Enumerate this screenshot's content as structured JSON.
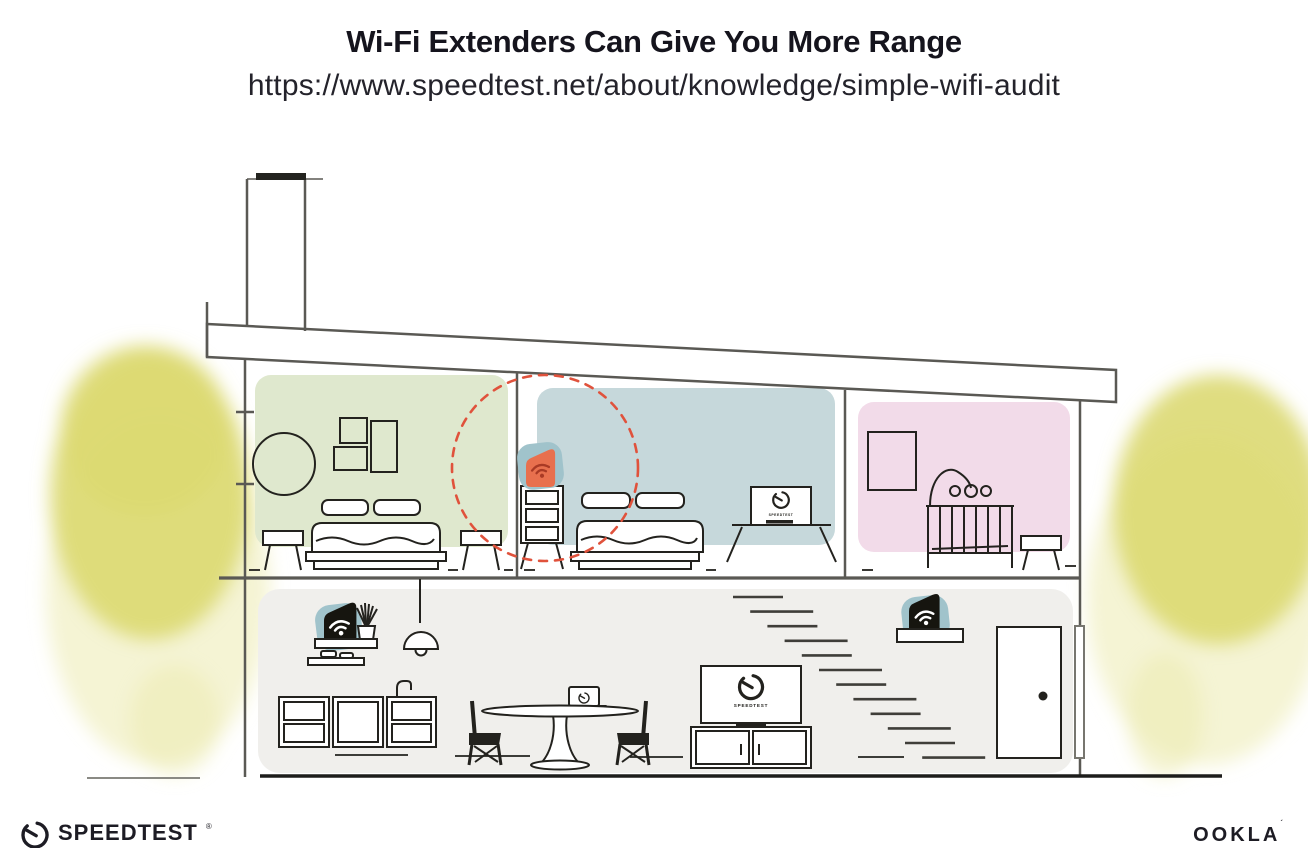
{
  "header": {
    "title": "Wi-Fi Extenders Can Give You More Range",
    "url": "https://www.speedtest.net/about/knowledge/simple-wifi-audit"
  },
  "footer": {
    "speedtest_wordmark": "SPEEDTEST",
    "speedtest_trademark": "®",
    "ookla_wordmark": "OOKLA",
    "ookla_trademark": "´"
  },
  "illustration": {
    "scene": "Cross-section of a two-story house showing a Wi-Fi router downstairs and Wi-Fi extenders, one upstairs circled with a dashed coverage ring",
    "tv_screen_label": "SPEEDTEST",
    "coverage_circle": "red dashed ring around upstairs wi-fi extender",
    "rooms": [
      {
        "name": "bedroom-green",
        "fill": "#dfe8ce",
        "furniture": [
          "round-mirror",
          "three-wall-frames",
          "double-bed",
          "two-nightstands"
        ]
      },
      {
        "name": "bedroom-blue",
        "fill": "#c6d8db",
        "furniture": [
          "dresser",
          "double-bed",
          "tv-on-stand"
        ],
        "device": "wifi-extender-orange"
      },
      {
        "name": "nursery-pink",
        "fill": "#f2dbe9",
        "furniture": [
          "wall-frame",
          "crib",
          "baby-mobile",
          "stool"
        ]
      },
      {
        "name": "living-area",
        "fill": "#f0efec",
        "furniture": [
          "wall-shelves",
          "plant",
          "pendant-lamp",
          "kitchen-cabinets",
          "sink-faucet",
          "dining-table",
          "laptop",
          "two-chairs",
          "tv",
          "media-console",
          "staircase",
          "front-door"
        ],
        "devices": [
          "wifi-router-black",
          "wifi-extender-black"
        ]
      }
    ],
    "colors": {
      "ink": "#15141d",
      "line": "#5a5954",
      "furniture": "#23221e",
      "room-green": "#dfe8ce",
      "room-blue": "#c6d8db",
      "room-pink": "#f2dbe9",
      "floor-gray": "#f0efec",
      "device-teal": "#a0c3cb",
      "device-orange": "#e8704e",
      "device-black": "#16150f",
      "wifi-red": "#a93a25",
      "coverage-red": "#e0523c",
      "tree-yellow": "#dcd972",
      "tree-yellow-light": "#ecebb0"
    },
    "stairs": {
      "count": 12
    }
  }
}
